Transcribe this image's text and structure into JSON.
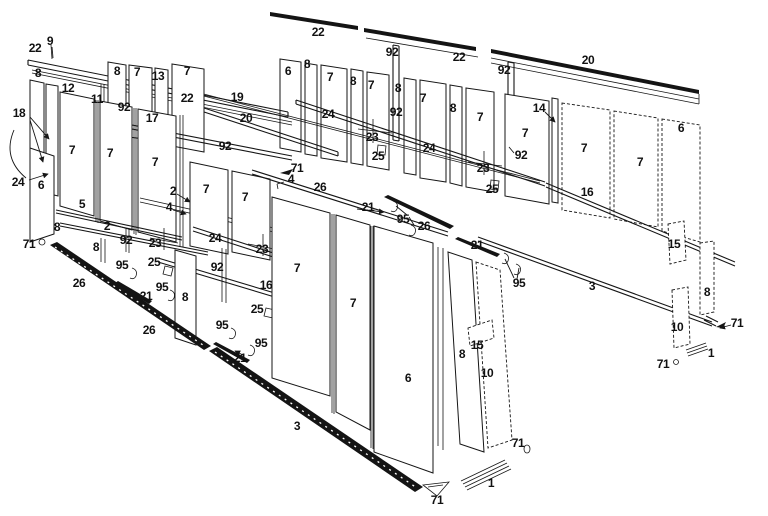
{
  "colors": {
    "ink": "#161616",
    "background": "#ffffff",
    "sill_fill": "#141414"
  },
  "part_labels": [
    {
      "t": "22",
      "x": 35,
      "y": 48
    },
    {
      "t": "9",
      "x": 50,
      "y": 41
    },
    {
      "t": "8",
      "x": 38,
      "y": 73
    },
    {
      "t": "12",
      "x": 68,
      "y": 88
    },
    {
      "t": "11",
      "x": 97,
      "y": 99
    },
    {
      "t": "92",
      "x": 124,
      "y": 107
    },
    {
      "t": "17",
      "x": 152,
      "y": 118
    },
    {
      "t": "18",
      "x": 19,
      "y": 113
    },
    {
      "t": "8",
      "x": 117,
      "y": 71
    },
    {
      "t": "7",
      "x": 137,
      "y": 72
    },
    {
      "t": "13",
      "x": 158,
      "y": 76
    },
    {
      "t": "7",
      "x": 187,
      "y": 71
    },
    {
      "t": "22",
      "x": 187,
      "y": 98
    },
    {
      "t": "19",
      "x": 237,
      "y": 97
    },
    {
      "t": "20",
      "x": 246,
      "y": 118
    },
    {
      "t": "92",
      "x": 225,
      "y": 146
    },
    {
      "t": "7",
      "x": 72,
      "y": 150
    },
    {
      "t": "7",
      "x": 110,
      "y": 153
    },
    {
      "t": "7",
      "x": 155,
      "y": 162
    },
    {
      "t": "7",
      "x": 206,
      "y": 189
    },
    {
      "t": "7",
      "x": 245,
      "y": 197
    },
    {
      "t": "24",
      "x": 18,
      "y": 182
    },
    {
      "t": "6",
      "x": 41,
      "y": 185
    },
    {
      "t": "5",
      "x": 82,
      "y": 204
    },
    {
      "t": "2",
      "x": 107,
      "y": 226
    },
    {
      "t": "2",
      "x": 173,
      "y": 191
    },
    {
      "t": "4",
      "x": 169,
      "y": 207
    },
    {
      "t": "8",
      "x": 57,
      "y": 227
    },
    {
      "t": "71",
      "x": 29,
      "y": 244
    },
    {
      "t": "92",
      "x": 126,
      "y": 240
    },
    {
      "t": "23",
      "x": 155,
      "y": 243
    },
    {
      "t": "25",
      "x": 154,
      "y": 262
    },
    {
      "t": "95",
      "x": 122,
      "y": 265
    },
    {
      "t": "8",
      "x": 96,
      "y": 247
    },
    {
      "t": "95",
      "x": 162,
      "y": 287
    },
    {
      "t": "26",
      "x": 79,
      "y": 283
    },
    {
      "t": "21",
      "x": 146,
      "y": 296
    },
    {
      "t": "26",
      "x": 149,
      "y": 330
    },
    {
      "t": "95",
      "x": 222,
      "y": 325
    },
    {
      "t": "95",
      "x": 261,
      "y": 343
    },
    {
      "t": "21",
      "x": 240,
      "y": 358
    },
    {
      "t": "8",
      "x": 185,
      "y": 297
    },
    {
      "t": "24",
      "x": 215,
      "y": 238
    },
    {
      "t": "23",
      "x": 262,
      "y": 249
    },
    {
      "t": "92",
      "x": 217,
      "y": 267
    },
    {
      "t": "16",
      "x": 266,
      "y": 285
    },
    {
      "t": "25",
      "x": 257,
      "y": 309
    },
    {
      "t": "71",
      "x": 297,
      "y": 168
    },
    {
      "t": "4",
      "x": 291,
      "y": 179
    },
    {
      "t": "26",
      "x": 320,
      "y": 187
    },
    {
      "t": "21",
      "x": 368,
      "y": 207
    },
    {
      "t": "95",
      "x": 403,
      "y": 219
    },
    {
      "t": "26",
      "x": 424,
      "y": 226
    },
    {
      "t": "7",
      "x": 297,
      "y": 268
    },
    {
      "t": "7",
      "x": 353,
      "y": 303
    },
    {
      "t": "3",
      "x": 297,
      "y": 426
    },
    {
      "t": "6",
      "x": 408,
      "y": 378
    },
    {
      "t": "8",
      "x": 462,
      "y": 354
    },
    {
      "t": "15",
      "x": 477,
      "y": 345
    },
    {
      "t": "10",
      "x": 487,
      "y": 373
    },
    {
      "t": "71",
      "x": 437,
      "y": 500
    },
    {
      "t": "1",
      "x": 491,
      "y": 483
    },
    {
      "t": "71",
      "x": 518,
      "y": 443
    },
    {
      "t": "21",
      "x": 477,
      "y": 245
    },
    {
      "t": "95",
      "x": 519,
      "y": 283
    },
    {
      "t": "3",
      "x": 592,
      "y": 286
    },
    {
      "t": "22",
      "x": 318,
      "y": 32
    },
    {
      "t": "92",
      "x": 392,
      "y": 52
    },
    {
      "t": "22",
      "x": 459,
      "y": 57
    },
    {
      "t": "92",
      "x": 504,
      "y": 70
    },
    {
      "t": "20",
      "x": 588,
      "y": 60
    },
    {
      "t": "6",
      "x": 288,
      "y": 71
    },
    {
      "t": "8",
      "x": 307,
      "y": 64
    },
    {
      "t": "7",
      "x": 330,
      "y": 77
    },
    {
      "t": "8",
      "x": 353,
      "y": 81
    },
    {
      "t": "7",
      "x": 371,
      "y": 85
    },
    {
      "t": "8",
      "x": 398,
      "y": 88
    },
    {
      "t": "7",
      "x": 423,
      "y": 98
    },
    {
      "t": "8",
      "x": 453,
      "y": 108
    },
    {
      "t": "7",
      "x": 480,
      "y": 117
    },
    {
      "t": "24",
      "x": 328,
      "y": 114
    },
    {
      "t": "92",
      "x": 396,
      "y": 112
    },
    {
      "t": "23",
      "x": 372,
      "y": 137
    },
    {
      "t": "25",
      "x": 378,
      "y": 156
    },
    {
      "t": "24",
      "x": 429,
      "y": 148
    },
    {
      "t": "23",
      "x": 483,
      "y": 168
    },
    {
      "t": "25",
      "x": 492,
      "y": 189
    },
    {
      "t": "92",
      "x": 521,
      "y": 155
    },
    {
      "t": "14",
      "x": 539,
      "y": 108
    },
    {
      "t": "7",
      "x": 525,
      "y": 133
    },
    {
      "t": "7",
      "x": 584,
      "y": 148
    },
    {
      "t": "7",
      "x": 640,
      "y": 162
    },
    {
      "t": "6",
      "x": 681,
      "y": 128
    },
    {
      "t": "16",
      "x": 587,
      "y": 192
    },
    {
      "t": "15",
      "x": 674,
      "y": 244
    },
    {
      "t": "8",
      "x": 707,
      "y": 292
    },
    {
      "t": "10",
      "x": 677,
      "y": 327
    },
    {
      "t": "71",
      "x": 737,
      "y": 323
    },
    {
      "t": "1",
      "x": 711,
      "y": 353
    },
    {
      "t": "71",
      "x": 663,
      "y": 364
    }
  ]
}
